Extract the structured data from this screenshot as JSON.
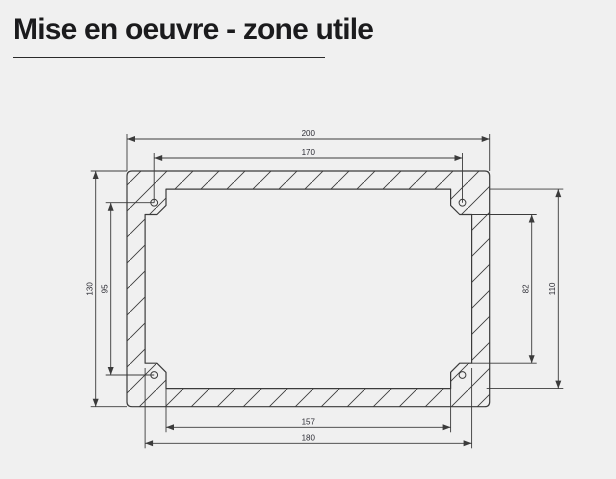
{
  "page": {
    "title": "Mise en oeuvre - zone utile",
    "background_color": "#f0f0f0",
    "title_color": "#1b1b1d"
  },
  "drawing": {
    "type": "technical-drawing",
    "description": "Front view of a rectangular mounting frame with hatched section, four corner screw holes and dimension lines",
    "line_color": "#3b3b3b",
    "dim_text_color": "#2b2b33",
    "dimensions_mm": {
      "outer_width": "200",
      "hole_spacing_horizontal": "170",
      "outer_height": "130",
      "hole_spacing_vertical": "95",
      "useful_zone_height": "82",
      "opening_height": "110",
      "useful_zone_width": "157",
      "opening_width": "180"
    }
  }
}
